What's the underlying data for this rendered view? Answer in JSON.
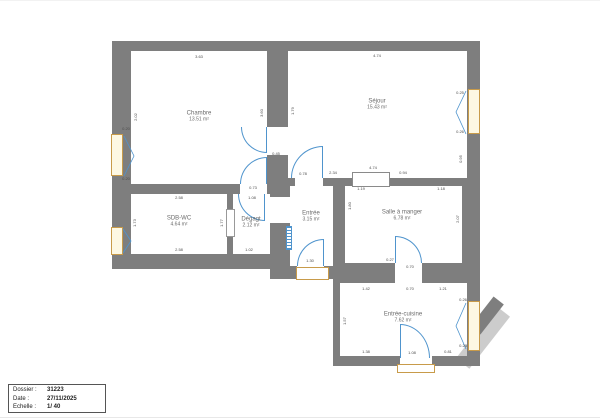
{
  "colors": {
    "wall": "#7e7e7e",
    "door": "#4f94cd",
    "window_border": "#c89b4a",
    "window_fill": "#fdf8e3",
    "dim": "#4d4d4d",
    "label": "#6b6b6b",
    "stairs": "#cccccc",
    "title_border": "#555555"
  },
  "titleblock": {
    "rows": [
      {
        "label": "Dossier :",
        "value": "31223"
      },
      {
        "label": "Date :",
        "value": "27/11/2025"
      },
      {
        "label": "Echelle :",
        "value": "1/ 40"
      }
    ]
  },
  "plan": {
    "rooms": [
      {
        "name": "Chambre",
        "area": "13.51 m²"
      },
      {
        "name": "Séjour",
        "area": "15.43 m²"
      },
      {
        "name": "SDB-WC",
        "area": "4.64 m²"
      },
      {
        "name": "Dégagt",
        "area": "2.12 m²"
      },
      {
        "name": "Entrée",
        "area": "3.15 m²"
      },
      {
        "name": "Salle à manger",
        "area": "6.78 m²"
      },
      {
        "name": "Entrée-cuisine",
        "area": "7.62 m²"
      }
    ],
    "dimensions": [
      {
        "text": "3.63",
        "x": 199,
        "y": 56,
        "o": "h"
      },
      {
        "text": "2.02",
        "x": 136,
        "y": 116,
        "o": "v"
      },
      {
        "text": "3.60",
        "x": 262,
        "y": 112,
        "o": "v"
      },
      {
        "text": "0.20",
        "x": 126,
        "y": 128,
        "o": "h"
      },
      {
        "text": "0.20",
        "x": 126,
        "y": 178,
        "o": "h"
      },
      {
        "text": "4.74",
        "x": 377,
        "y": 55,
        "o": "h"
      },
      {
        "text": "1.79",
        "x": 293,
        "y": 110,
        "o": "v"
      },
      {
        "text": "0.25",
        "x": 460,
        "y": 92,
        "o": "h"
      },
      {
        "text": "0.26",
        "x": 460,
        "y": 131,
        "o": "h"
      },
      {
        "text": "0.95",
        "x": 461,
        "y": 158,
        "o": "v"
      },
      {
        "text": "0.45",
        "x": 276,
        "y": 153,
        "o": "h"
      },
      {
        "text": "0.73",
        "x": 253,
        "y": 187,
        "o": "h"
      },
      {
        "text": "0.78",
        "x": 303,
        "y": 173,
        "o": "h"
      },
      {
        "text": "2.34",
        "x": 333,
        "y": 172,
        "o": "h"
      },
      {
        "text": "4.74",
        "x": 373,
        "y": 167,
        "o": "h"
      },
      {
        "text": "0.94",
        "x": 403,
        "y": 172,
        "o": "h"
      },
      {
        "text": "1.19",
        "x": 361,
        "y": 188,
        "o": "h"
      },
      {
        "text": "1.18",
        "x": 441,
        "y": 188,
        "o": "h"
      },
      {
        "text": "2.58",
        "x": 179,
        "y": 197,
        "o": "h"
      },
      {
        "text": "1.08",
        "x": 252,
        "y": 197,
        "o": "h"
      },
      {
        "text": "1.73",
        "x": 135,
        "y": 222,
        "o": "v"
      },
      {
        "text": "1.77",
        "x": 222,
        "y": 222,
        "o": "v"
      },
      {
        "text": "2.58",
        "x": 179,
        "y": 249,
        "o": "h"
      },
      {
        "text": "1.02",
        "x": 249,
        "y": 249,
        "o": "h"
      },
      {
        "text": "1.80",
        "x": 350,
        "y": 205,
        "o": "v"
      },
      {
        "text": "2.07",
        "x": 458,
        "y": 218,
        "o": "v"
      },
      {
        "text": "1.30",
        "x": 310,
        "y": 260,
        "o": "h"
      },
      {
        "text": "0.27",
        "x": 390,
        "y": 259,
        "o": "h"
      },
      {
        "text": "0.70",
        "x": 410,
        "y": 266,
        "o": "h"
      },
      {
        "text": "1.42",
        "x": 366,
        "y": 288,
        "o": "h"
      },
      {
        "text": "0.70",
        "x": 410,
        "y": 288,
        "o": "h"
      },
      {
        "text": "1.21",
        "x": 443,
        "y": 288,
        "o": "h"
      },
      {
        "text": "1.57",
        "x": 345,
        "y": 320,
        "o": "v"
      },
      {
        "text": "0.26",
        "x": 463,
        "y": 299,
        "o": "h"
      },
      {
        "text": "0.28",
        "x": 463,
        "y": 345,
        "o": "h"
      },
      {
        "text": "1.38",
        "x": 366,
        "y": 351,
        "o": "h"
      },
      {
        "text": "1.08",
        "x": 412,
        "y": 352,
        "o": "h"
      },
      {
        "text": "0.81",
        "x": 448,
        "y": 351,
        "o": "h"
      }
    ]
  }
}
